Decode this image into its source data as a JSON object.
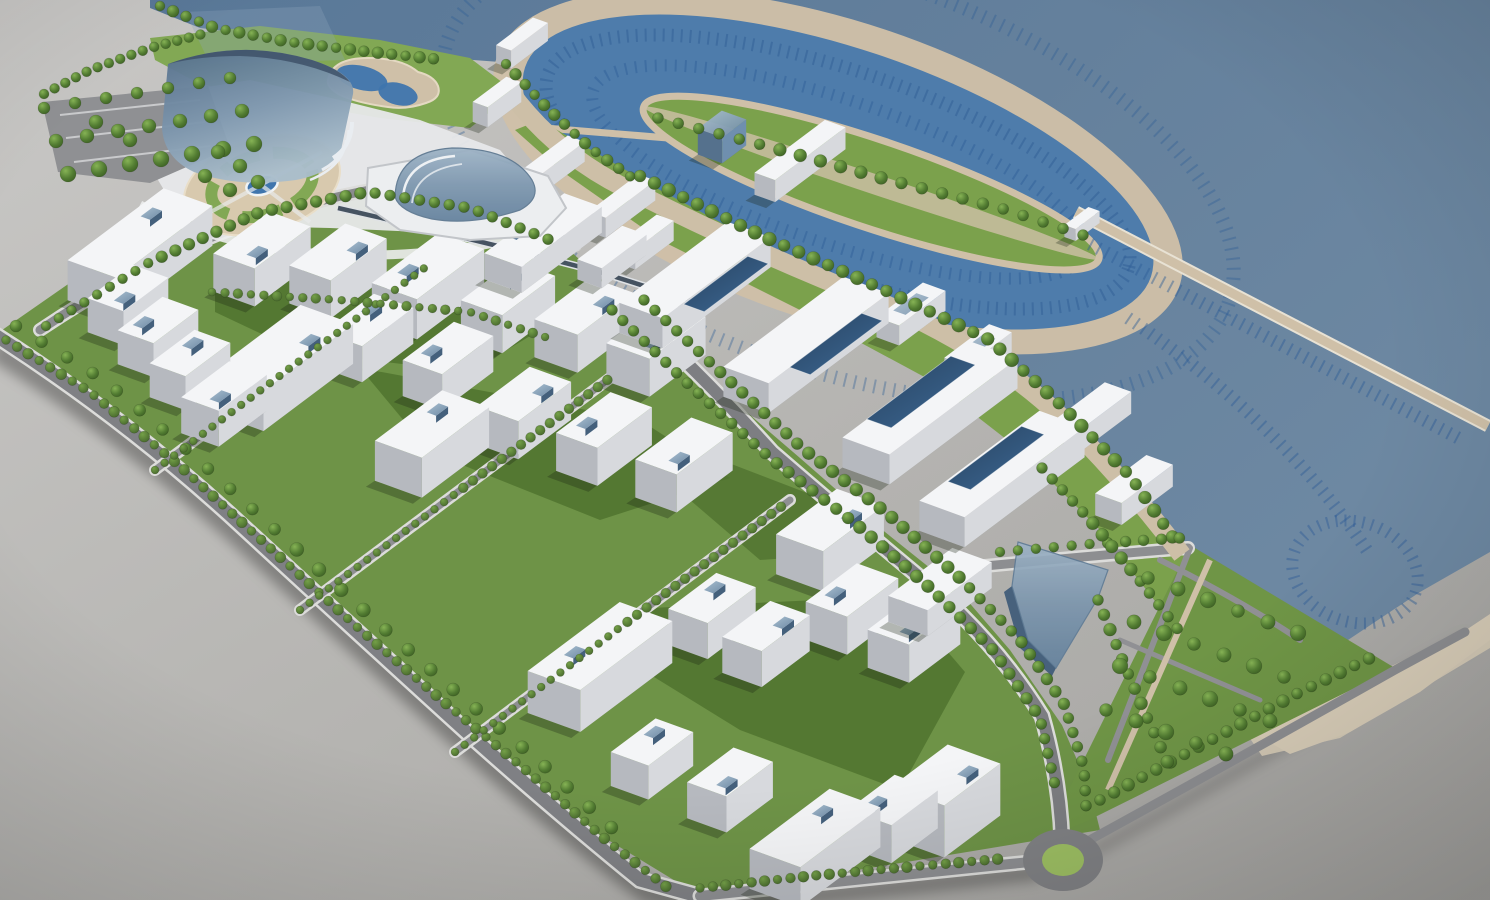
{
  "meta": {
    "title": "Waterfront masterplan — aerial 3D architectural visualization",
    "media_type": "photorealistic 3D render of an urban-design model",
    "view": "high-angle oblique aerial view, site rotated diagonally across the frame",
    "canvas": {
      "width": 1490,
      "height": 900
    }
  },
  "palette": {
    "ground": "#b6b5b2",
    "groundLight": "#c9c8c6",
    "groundDark": "#a5a4a1",
    "sea": "#617e9b",
    "marinaWater": "#4e7cab",
    "slipLine": "#2f5e96",
    "sand": "#cfc0a8",
    "beach": "#d8cdb8",
    "promenade": "#cdbfa7",
    "grass": "#6e9347",
    "lawnLight": "#82a854",
    "shoreLawn": "#7ba14c",
    "courtyard": "#50732f",
    "parkGreen": "#6f9546",
    "treeDark": "#3c5f23",
    "treeLight": "#86b355",
    "hedge": "#5a8038",
    "road": "#7f8084",
    "roadLight": "#8d8e91",
    "curb": "#dcdcda",
    "buildingTop": "#f4f5f7",
    "buildingFront": "#d7d9dd",
    "buildingSide": "#b6b9bf",
    "navyRoof": "#2f5075",
    "glass": "#8fa7bd",
    "glassDark": "#5d7d9b",
    "fountain": "#3f75ad",
    "roundaboutGreen": "#9dbf63",
    "transit": "#2c3a4a"
  },
  "scene": {
    "description": "Rendered physical-model style masterplan: a coastal district with white residential cubes around green courtyards on the left, a curved glass landmark tower and circular fountain plaza at the top left, an elliptical marina with a lens-shaped island in the bay, long white office slabs with navy glass roofs along the shore, a sandy beach wrapping a rounded harbour basin, a triangular tree-grid park and a roundabout at the bottom edge, all sitting on a neutral grey base plane.",
    "elements": [
      {
        "name": "ground-plane",
        "description": "neutral grey base plane with soft vignette"
      },
      {
        "name": "sea",
        "description": "large steel-blue bay filling the upper right of the frame"
      },
      {
        "name": "marina-basin",
        "description": "elliptical yacht harbour ringed by rows of boat slips"
      },
      {
        "name": "marina-island",
        "description": "lens-shaped island with lawn, tree row, white hall and glass cube pavilion"
      },
      {
        "name": "breakwater-pier",
        "description": "long straight sand-coloured pier running toward the lower right"
      },
      {
        "name": "boat-slips",
        "description": "dark-blue tick rows of moorings along quays, pier and basin"
      },
      {
        "name": "beach",
        "description": "sand strip wrapping the rounded end of the inner harbour"
      },
      {
        "name": "promenade",
        "description": "wide curved sand-coloured waterfront walkway"
      },
      {
        "name": "glass-tower",
        "description": "curved stepped blue-glass landmark building at the top left"
      },
      {
        "name": "shell-mall",
        "description": "white podium with a curved glass shell roof"
      },
      {
        "name": "circular-plaza",
        "description": "round plaza with concentric lawn ring and blue fountain"
      },
      {
        "name": "ornamental-pond",
        "description": "organic blue pond with timber deck north of the plaza"
      },
      {
        "name": "parking-grove",
        "description": "tree-shaded parking lot at the far left edge"
      },
      {
        "name": "residential-blocks",
        "count": 29,
        "description": "white apartment cubes with small blue rooftop cores around dark-green courtyards"
      },
      {
        "name": "central-complex",
        "description": "zig-zag white slab buildings with long navy glass roof lights"
      },
      {
        "name": "waterfront-offices",
        "description": "two long curved office slabs with navy roof lights near the shore"
      },
      {
        "name": "glass-pavilion",
        "description": "triangular translucent glass wedge near the south shore"
      },
      {
        "name": "tree-lined-avenue",
        "description": "main curved avenue with double tree rows running to the roundabout"
      },
      {
        "name": "perimeter-road",
        "description": "boundary road with continuous hedge row along the lower left edge"
      },
      {
        "name": "triangular-park",
        "description": "park with orchard grid of trees at the lower right"
      },
      {
        "name": "roundabout",
        "description": "roundabout with a light-green centre island at the bottom edge"
      }
    ]
  }
}
